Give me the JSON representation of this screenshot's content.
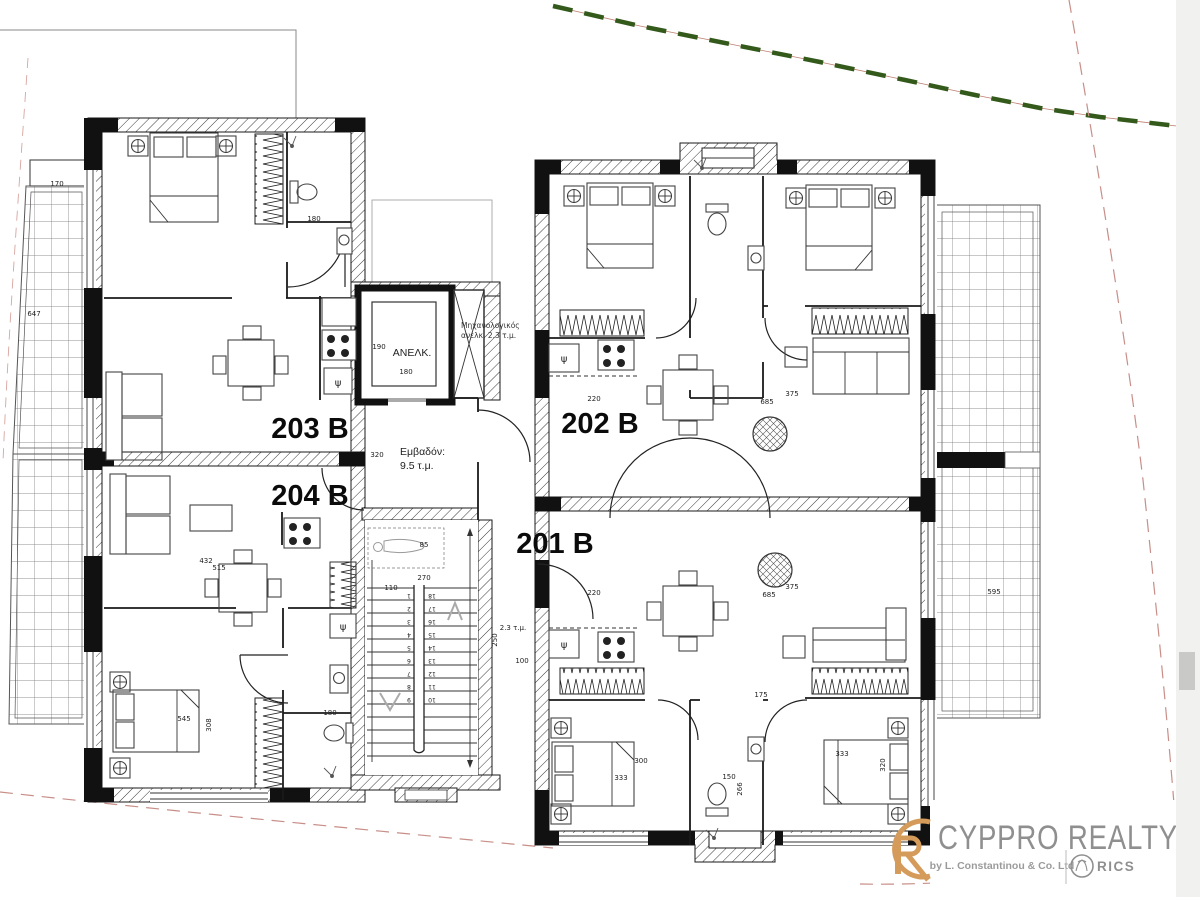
{
  "plan": {
    "units": [
      {
        "label": "203 B"
      },
      {
        "label": "204 B"
      },
      {
        "label": "202 B"
      },
      {
        "label": "201 B"
      }
    ],
    "core": {
      "elevator": "ΑΝΕΛΚ.",
      "mech1": "Μηχανολογικός",
      "mech2": "ανελκ. 2.3 τ.μ.",
      "area1": "Εμβαδόν:",
      "area2": "9.5 τ.μ."
    },
    "sink": "ψ",
    "dims": [
      "170",
      "647",
      "190",
      "180",
      "320",
      "110",
      "270",
      "85",
      "2.3 τ.μ.",
      "100",
      "250",
      "220",
      "685",
      "375",
      "220",
      "685",
      "375",
      "175",
      "300",
      "333",
      "150",
      "266",
      "333",
      "320",
      "432",
      "515",
      "545",
      "308",
      "180",
      "180",
      "595"
    ],
    "stairs": {
      "left": [
        "1",
        "2",
        "3",
        "4",
        "5",
        "6",
        "7",
        "8",
        "9"
      ],
      "right": [
        "18",
        "17",
        "16",
        "15",
        "14",
        "13",
        "12",
        "11",
        "10"
      ]
    }
  },
  "logo": {
    "brand": "CYPPRO REALTY",
    "byline": "by L. Constantinou & Co. Ltd",
    "rics": "RICS"
  },
  "colors": {
    "boundary_green": "#33591b",
    "boundary_red": "#c88e88",
    "monogram_orange": "#d49b5b",
    "logo_gray": "#8f8f8f"
  }
}
